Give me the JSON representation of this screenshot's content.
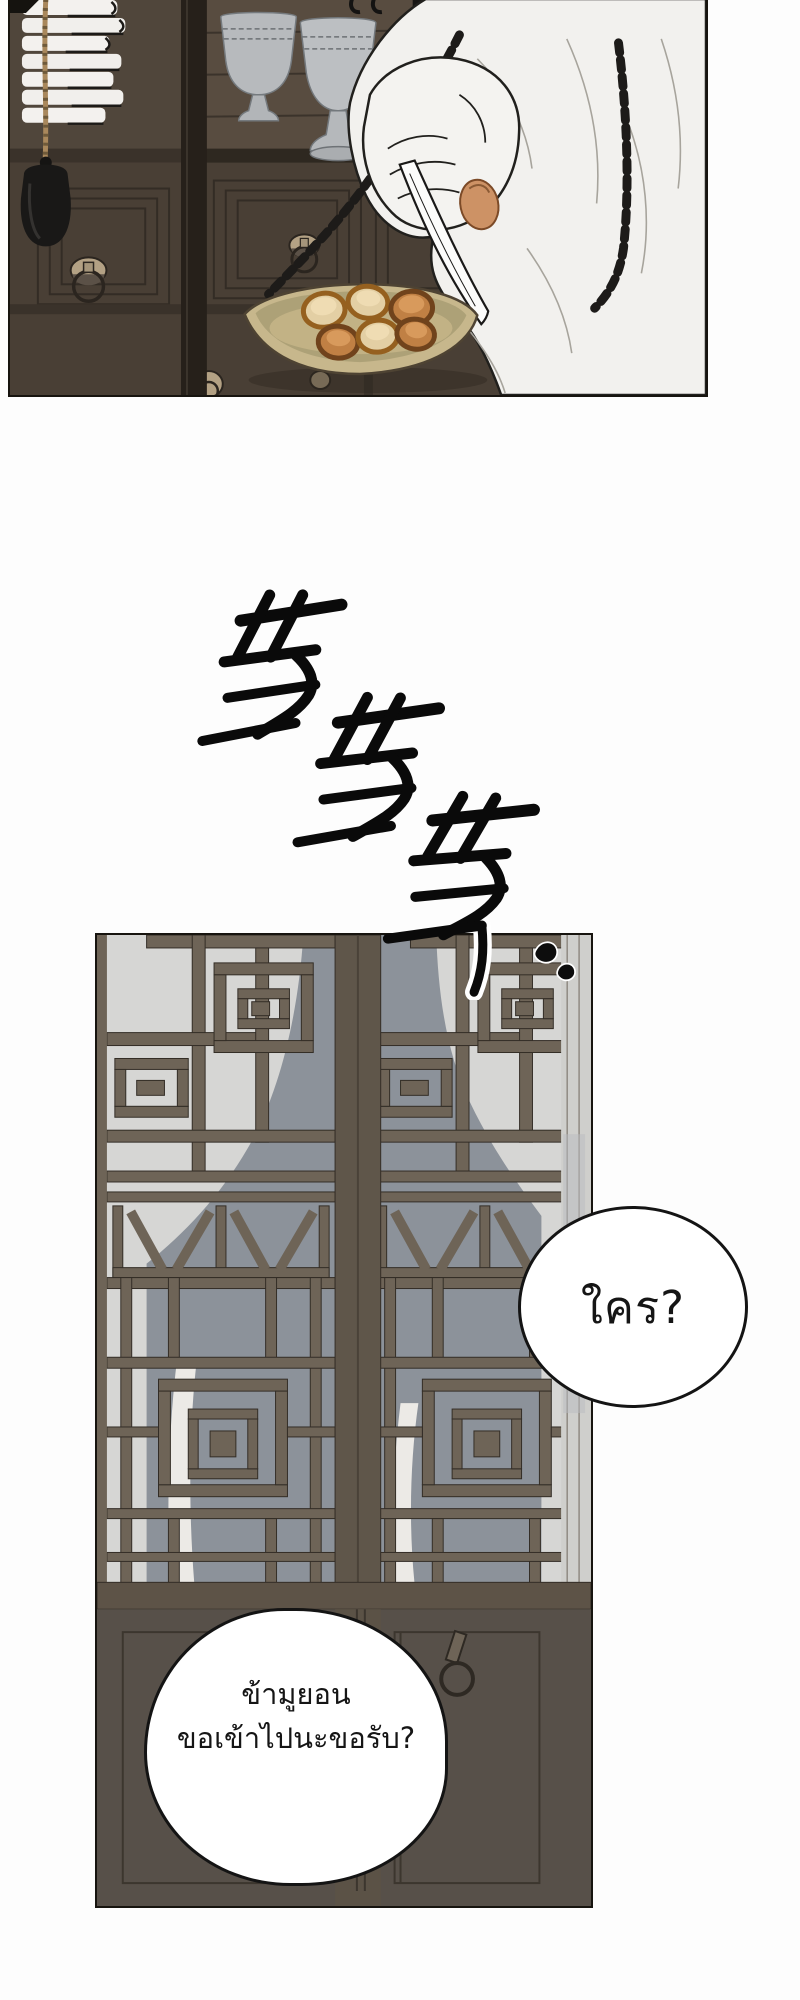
{
  "page": {
    "kind": "comic-page",
    "background": "#fdfdfd",
    "panel_count": 2,
    "speech_bubble_count": 2
  },
  "panel_apothecary": {
    "label": "hand holding hanging balance scale over medicine drawers",
    "medicine_piece_count": 6,
    "colors": {
      "wood_dark": "#4c4138",
      "wood_light": "#584c40",
      "bowl_gray": "#bcbfc2",
      "paper_white": "#f3f1ee",
      "rope": "#a9885c",
      "weight_black": "#191817",
      "chain_black": "#1d1b19",
      "sleeve_white": "#f2f1ee",
      "skin": "#cd9265",
      "pan_tan": "#c7b78c",
      "brass": "#b3a184"
    }
  },
  "panel_door": {
    "label": "lattice door with silhouette behind paper",
    "colors": {
      "paper_gray": "#d6d6d4",
      "silhouette": "#8c929a",
      "lattice_wood": "#6e6457",
      "lower_panel": "#575049"
    },
    "knock_mark_count": 2
  },
  "sfx": {
    "text": "똑똑똑",
    "color": "#0a0a0a"
  },
  "speech": {
    "who": {
      "text": "ใคร?"
    },
    "request": {
      "line1": "ข้ามูยอน",
      "line2": "ขอเข้าไปนะขอรับ?"
    }
  }
}
